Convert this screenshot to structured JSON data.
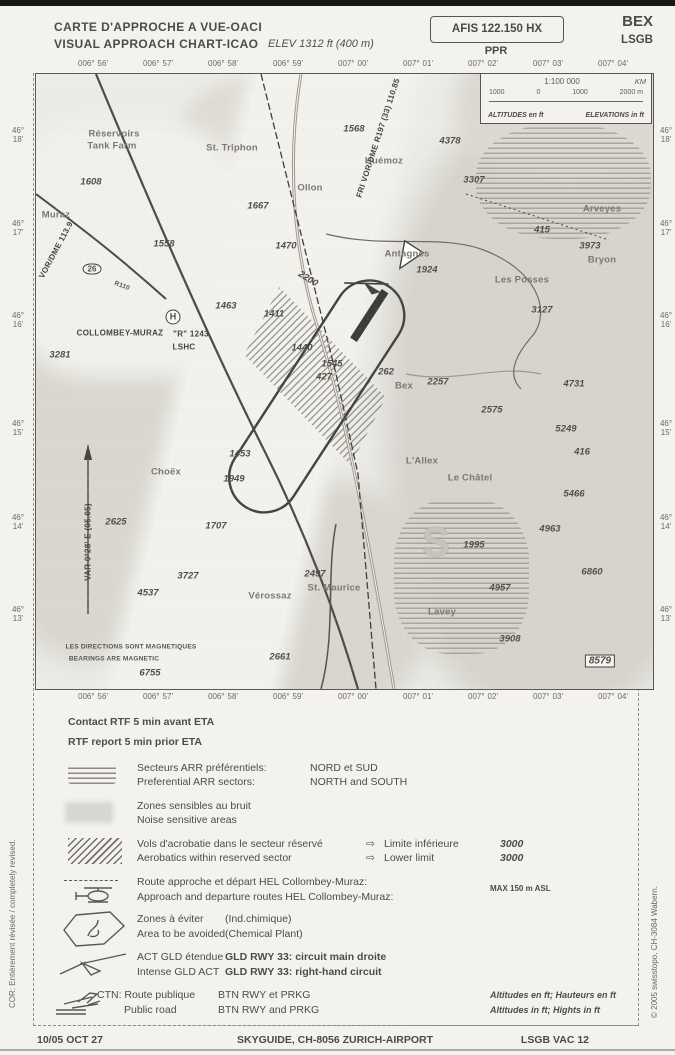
{
  "header": {
    "title_fr": "CARTE D'APPROCHE A VUE-OACI",
    "title_en": "VISUAL APPROACH CHART-ICAO",
    "elevation": "ELEV 1312 ft (400 m)",
    "afis": "AFIS 122.150 HX",
    "ppr": "PPR",
    "icao_name": "BEX",
    "icao_code": "LSGB"
  },
  "scalebox": {
    "scale": "1:100 000",
    "unit": "KM",
    "ticks": [
      "1000",
      "0",
      "1000",
      "2000 m"
    ],
    "altitudes_label": "ALTITUDES en ft",
    "elevations_label": "ELEVATIONS in ft"
  },
  "map": {
    "lon_labels": [
      {
        "d": "006°",
        "m": "56'"
      },
      {
        "d": "006°",
        "m": "57'"
      },
      {
        "d": "006°",
        "m": "58'"
      },
      {
        "d": "006°",
        "m": "59'"
      },
      {
        "d": "007°",
        "m": "00'"
      },
      {
        "d": "007°",
        "m": "01'"
      },
      {
        "d": "007°",
        "m": "02'"
      },
      {
        "d": "007°",
        "m": "03'"
      },
      {
        "d": "007°",
        "m": "04'"
      }
    ],
    "lat_labels": [
      {
        "deg": "46°",
        "min": "18'",
        "y": 62
      },
      {
        "deg": "46°",
        "min": "17'",
        "y": 155
      },
      {
        "deg": "46°",
        "min": "16'",
        "y": 247
      },
      {
        "deg": "46°",
        "min": "15'",
        "y": 355
      },
      {
        "deg": "46°",
        "min": "14'",
        "y": 449
      },
      {
        "deg": "46°",
        "min": "13'",
        "y": 541
      }
    ],
    "labels": [
      {
        "t": "Réservoirs",
        "x": 78,
        "y": 60,
        "c": "pl"
      },
      {
        "t": "Tank Farm",
        "x": 76,
        "y": 72,
        "c": "pl"
      },
      {
        "t": "1608",
        "x": 55,
        "y": 108,
        "c": "el"
      },
      {
        "t": "St. Triphon",
        "x": 196,
        "y": 74,
        "c": "pl"
      },
      {
        "t": "1568",
        "x": 318,
        "y": 55,
        "c": "el"
      },
      {
        "t": "Ollon",
        "x": 274,
        "y": 114,
        "c": "pl"
      },
      {
        "t": "1667",
        "x": 222,
        "y": 132,
        "c": "el"
      },
      {
        "t": "Muraz",
        "x": 20,
        "y": 141,
        "c": "pl"
      },
      {
        "t": "1558",
        "x": 128,
        "y": 170,
        "c": "el"
      },
      {
        "t": "1470",
        "x": 250,
        "y": 172,
        "c": "el"
      },
      {
        "t": "4378",
        "x": 414,
        "y": 67,
        "c": "el"
      },
      {
        "t": "Huémoz",
        "x": 348,
        "y": 87,
        "c": "pl"
      },
      {
        "t": "3307",
        "x": 438,
        "y": 106,
        "c": "el"
      },
      {
        "t": "Antagnes",
        "x": 371,
        "y": 180,
        "c": "pl"
      },
      {
        "t": "1924",
        "x": 391,
        "y": 196,
        "c": "el"
      },
      {
        "t": "Les Posses",
        "x": 486,
        "y": 206,
        "c": "pl"
      },
      {
        "t": "3127",
        "x": 506,
        "y": 236,
        "c": "el"
      },
      {
        "t": "Arveyes",
        "x": 566,
        "y": 135,
        "c": "pl"
      },
      {
        "t": "415",
        "x": 506,
        "y": 156,
        "c": "el"
      },
      {
        "t": "3973",
        "x": 554,
        "y": 172,
        "c": "el"
      },
      {
        "t": "Bryon",
        "x": 566,
        "y": 186,
        "c": "pl"
      },
      {
        "t": "FRI VOR/DME R197 (33) 110.85",
        "x": 342,
        "y": 64,
        "c": "info",
        "r": -72
      },
      {
        "t": "H",
        "x": 137,
        "y": 243,
        "c": "hsym"
      },
      {
        "t": "COLLOMBEY-MURAZ",
        "x": 84,
        "y": 259,
        "c": "info"
      },
      {
        "t": "\"R\" 1243",
        "x": 155,
        "y": 260,
        "c": "info"
      },
      {
        "t": "LSHC",
        "x": 148,
        "y": 273,
        "c": "info"
      },
      {
        "t": "3281",
        "x": 24,
        "y": 281,
        "c": "el"
      },
      {
        "t": "1463",
        "x": 190,
        "y": 232,
        "c": "el"
      },
      {
        "t": "2200",
        "x": 272,
        "y": 205,
        "c": "el",
        "r": 32
      },
      {
        "t": "1411",
        "x": 238,
        "y": 240,
        "c": "el"
      },
      {
        "t": "1440",
        "x": 266,
        "y": 274,
        "c": "el"
      },
      {
        "t": "1545",
        "x": 296,
        "y": 290,
        "c": "el"
      },
      {
        "t": "427",
        "x": 288,
        "y": 303,
        "c": "el"
      },
      {
        "t": "262",
        "x": 350,
        "y": 298,
        "c": "el"
      },
      {
        "t": "Bex",
        "x": 368,
        "y": 312,
        "c": "pl"
      },
      {
        "t": "2257",
        "x": 402,
        "y": 308,
        "c": "el"
      },
      {
        "t": "2575",
        "x": 456,
        "y": 336,
        "c": "el"
      },
      {
        "t": "4731",
        "x": 538,
        "y": 310,
        "c": "el"
      },
      {
        "t": "5249",
        "x": 530,
        "y": 355,
        "c": "el"
      },
      {
        "t": "416",
        "x": 546,
        "y": 378,
        "c": "el"
      },
      {
        "t": "1453",
        "x": 204,
        "y": 380,
        "c": "el"
      },
      {
        "t": "L'Allex",
        "x": 386,
        "y": 387,
        "c": "pl"
      },
      {
        "t": "Le Châtel",
        "x": 434,
        "y": 404,
        "c": "pl"
      },
      {
        "t": "Choëx",
        "x": 130,
        "y": 398,
        "c": "pl"
      },
      {
        "t": "1949",
        "x": 198,
        "y": 405,
        "c": "el"
      },
      {
        "t": "2625",
        "x": 80,
        "y": 448,
        "c": "el"
      },
      {
        "t": "1707",
        "x": 180,
        "y": 452,
        "c": "el"
      },
      {
        "t": "5466",
        "x": 538,
        "y": 420,
        "c": "el"
      },
      {
        "t": "4963",
        "x": 514,
        "y": 455,
        "c": "el"
      },
      {
        "t": "S",
        "x": 400,
        "y": 468,
        "c": "bigS"
      },
      {
        "t": "1995",
        "x": 438,
        "y": 471,
        "c": "el"
      },
      {
        "t": "3727",
        "x": 152,
        "y": 502,
        "c": "el"
      },
      {
        "t": "4537",
        "x": 112,
        "y": 519,
        "c": "el"
      },
      {
        "t": "2497",
        "x": 279,
        "y": 500,
        "c": "el"
      },
      {
        "t": "St. Maurice",
        "x": 298,
        "y": 514,
        "c": "pl"
      },
      {
        "t": "Vérossaz",
        "x": 234,
        "y": 522,
        "c": "pl"
      },
      {
        "t": "6860",
        "x": 556,
        "y": 498,
        "c": "el"
      },
      {
        "t": "4957",
        "x": 464,
        "y": 514,
        "c": "el"
      },
      {
        "t": "Lavey",
        "x": 406,
        "y": 538,
        "c": "pl"
      },
      {
        "t": "3908",
        "x": 474,
        "y": 565,
        "c": "el"
      },
      {
        "t": "8579",
        "x": 564,
        "y": 587,
        "c": "boxv"
      },
      {
        "t": "2661",
        "x": 244,
        "y": 583,
        "c": "el"
      },
      {
        "t": "6755",
        "x": 114,
        "y": 599,
        "c": "el"
      },
      {
        "t": "VAR 0°28' E (05.05)",
        "x": 52,
        "y": 468,
        "c": "info",
        "r": -90
      },
      {
        "t": "LES DIRECTIONS SONT MAGNETIQUES",
        "x": 95,
        "y": 573,
        "c": "tiny"
      },
      {
        "t": "BEARINGS ARE MAGNETIC",
        "x": 78,
        "y": 585,
        "c": "tiny"
      },
      {
        "t": "26",
        "x": 56,
        "y": 195,
        "c": "shield"
      },
      {
        "t": "R110",
        "x": 86,
        "y": 212,
        "c": "tiny",
        "r": 20
      },
      {
        "t": "VOR/DME 113.9",
        "x": 20,
        "y": 176,
        "c": "info",
        "r": -62
      }
    ]
  },
  "legend": {
    "contact_fr": "Contact RTF 5 min avant ETA",
    "contact_en": "RTF report 5 min prior ETA",
    "rows": [
      {
        "fr": "Secteurs ARR préférentiels:",
        "en": "Preferential ARR sectors:",
        "fr2": "NORD et SUD",
        "en2": "NORTH and SOUTH"
      },
      {
        "fr": "Zones sensibles au bruit",
        "en": "Noise sensitive areas"
      },
      {
        "fr": "Vols d'acrobatie dans le secteur réservé",
        "en": "Aerobatics within reserved sector",
        "arrow": "⇨",
        "fr2": "Limite inférieure",
        "en2": "Lower limit",
        "value": "3000"
      },
      {
        "fr": "Route approche et départ HEL Collombey-Muraz:",
        "en": "Approach and departure routes HEL Collombey-Muraz:",
        "note": "MAX 150 m ASL"
      },
      {
        "fr": "Zones à éviter",
        "en": "Area to be avoided",
        "fr2": "(Ind.chimique)",
        "en2": "(Chemical Plant)"
      },
      {
        "fr": "ACT GLD étendue",
        "en": "Intense GLD ACT",
        "fr2": "GLD RWY 33: circuit main droite",
        "en2": "GLD RWY 33: right-hand circuit"
      },
      {
        "fr": "CTN: Route publique",
        "en": "Public road",
        "fr2": "BTN RWY et PRKG",
        "en2": "BTN RWY and PRKG",
        "note_fr": "Altitudes en ft; Hauteurs en ft",
        "note_en": "Altitudes in ft; Hights in ft"
      }
    ]
  },
  "sidenotes": {
    "left": "COR: Entièrement révisée / completely revised.",
    "right": "© 2005 swisstopo, CH-3084 Wabern."
  },
  "footer": {
    "date": "10/05 OCT 27",
    "publisher": "SKYGUIDE, CH-8056 ZURICH-AIRPORT",
    "chart_ref": "LSGB VAC 12"
  }
}
